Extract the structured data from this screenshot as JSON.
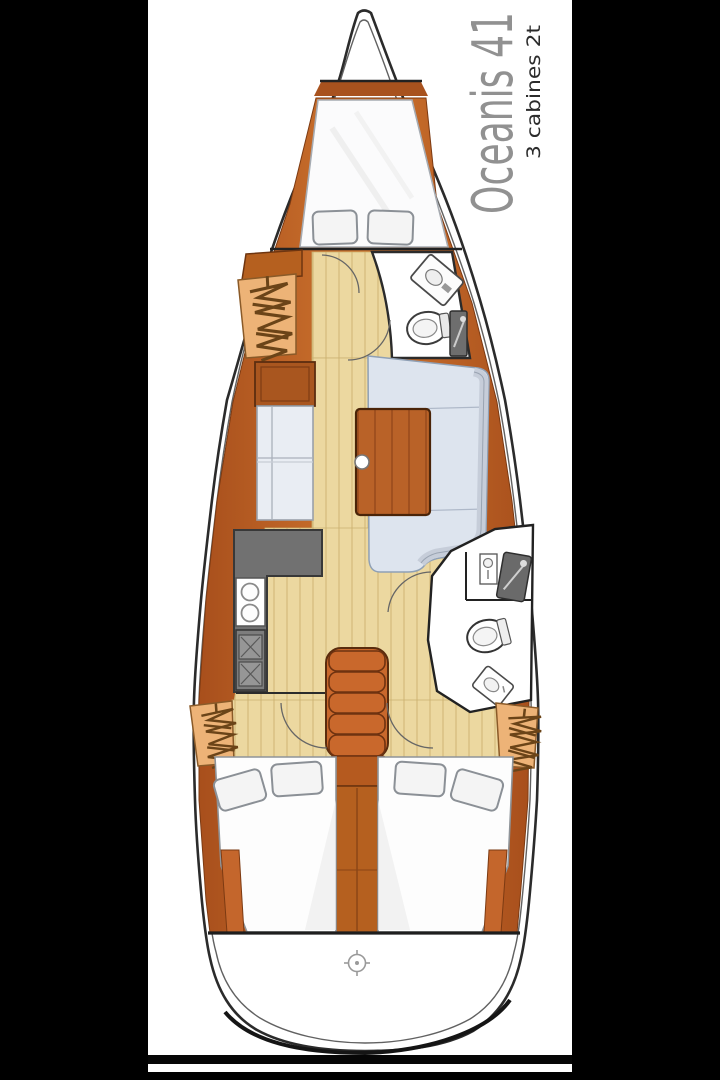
{
  "header": {
    "title": "Oceanis 41",
    "subtitle": "3 cabines 2t",
    "title_color": "#919191",
    "subtitle_color": "#2b2b2b"
  },
  "palette": {
    "background": "#000000",
    "sheet": "#ffffff",
    "hull_line": "#2b2b2b",
    "wood_trim": "#c4662c",
    "wood_dark": "#7c3a12",
    "furniture_wood": "#b96228",
    "floor": "#ecd8a0",
    "floor_line": "#d6bd7e",
    "locker_tan": "#edb377",
    "upholstery_blue": "#dde4ee",
    "upholstery_white": "#f3f4f6",
    "counter_gray": "#717171",
    "fixture_outline": "#3c3c3c"
  },
  "icons": [
    "hanging-clothes-icon",
    "vanity-sink-icon",
    "toilet-icon",
    "shower-icon",
    "galley-sink-icon",
    "stove-burner-icon",
    "door-swing-arc",
    "helm-compass-icon"
  ]
}
